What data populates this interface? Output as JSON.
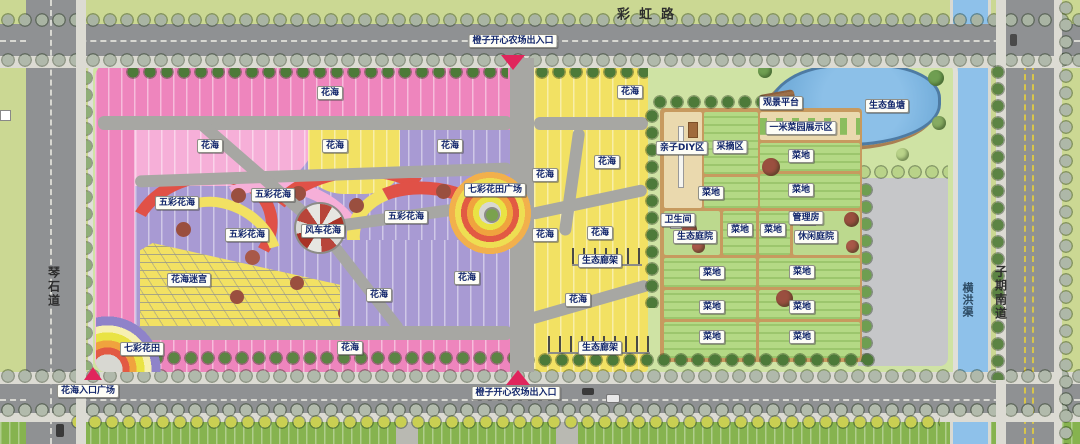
{
  "map": {
    "title": "橙子开心农场 平面图",
    "roads": {
      "north_road": "彩虹路",
      "west_road": "琴石道",
      "east_road": "子期南道",
      "east_channel": "横洪渠"
    },
    "entrances": {
      "north": "橙子开心农场出入口",
      "south": "橙子开心农场出入口",
      "southwest_plaza": "花海入口广场"
    },
    "labels": [
      {
        "t": "彩虹路",
        "x": 650,
        "y": 13,
        "k": "roadh",
        "n": "road-label-caihong"
      },
      {
        "t": "琴石道",
        "x": 54,
        "y": 287,
        "k": "roadv",
        "n": "road-label-qinshi"
      },
      {
        "t": "子期南道",
        "x": 1001,
        "y": 293,
        "k": "roadv",
        "n": "road-label-ziqinan"
      },
      {
        "t": "横洪渠",
        "x": 967,
        "y": 300,
        "k": "roadv-water",
        "n": "channel-label-henghong"
      },
      {
        "t": "橙子开心农场出入口",
        "x": 513,
        "y": 41,
        "k": "area",
        "n": "entrance-label-north"
      },
      {
        "t": "橙子开心农场出入口",
        "x": 516,
        "y": 393,
        "k": "area",
        "n": "entrance-label-south"
      },
      {
        "t": "花海入口广场",
        "x": 88,
        "y": 391,
        "k": "area",
        "n": "entrance-label-flower-plaza"
      },
      {
        "t": "花海",
        "x": 330,
        "y": 93,
        "k": "area",
        "n": "label-flower-sea"
      },
      {
        "t": "花海",
        "x": 210,
        "y": 146,
        "k": "area",
        "n": "label-flower-sea"
      },
      {
        "t": "花海",
        "x": 335,
        "y": 146,
        "k": "area",
        "n": "label-flower-sea"
      },
      {
        "t": "花海",
        "x": 450,
        "y": 146,
        "k": "area",
        "n": "label-flower-sea"
      },
      {
        "t": "五彩花海",
        "x": 273,
        "y": 195,
        "k": "area",
        "n": "label-multicolor-flower-sea"
      },
      {
        "t": "五彩花海",
        "x": 177,
        "y": 203,
        "k": "area",
        "n": "label-multicolor-flower-sea"
      },
      {
        "t": "五彩花海",
        "x": 247,
        "y": 235,
        "k": "area",
        "n": "label-multicolor-flower-sea"
      },
      {
        "t": "风车花海",
        "x": 323,
        "y": 231,
        "k": "area",
        "n": "label-windmill-flower-sea"
      },
      {
        "t": "五彩花海",
        "x": 406,
        "y": 217,
        "k": "area",
        "n": "label-multicolor-flower-sea"
      },
      {
        "t": "七彩花田广场",
        "x": 495,
        "y": 190,
        "k": "area",
        "n": "label-rainbow-field-plaza"
      },
      {
        "t": "花海迷宫",
        "x": 189,
        "y": 280,
        "k": "area",
        "n": "label-flower-maze"
      },
      {
        "t": "花海",
        "x": 379,
        "y": 295,
        "k": "area",
        "n": "label-flower-sea"
      },
      {
        "t": "花海",
        "x": 467,
        "y": 278,
        "k": "area",
        "n": "label-flower-sea"
      },
      {
        "t": "花海",
        "x": 350,
        "y": 348,
        "k": "area",
        "n": "label-flower-sea"
      },
      {
        "t": "七彩花田",
        "x": 142,
        "y": 349,
        "k": "area",
        "n": "label-rainbow-flower-field"
      },
      {
        "t": "花海",
        "x": 630,
        "y": 92,
        "k": "area",
        "n": "label-flower-sea"
      },
      {
        "t": "花海",
        "x": 607,
        "y": 162,
        "k": "area",
        "n": "label-flower-sea"
      },
      {
        "t": "花海",
        "x": 545,
        "y": 175,
        "k": "area",
        "n": "label-flower-sea"
      },
      {
        "t": "花海",
        "x": 545,
        "y": 235,
        "k": "area",
        "n": "label-flower-sea"
      },
      {
        "t": "花海",
        "x": 600,
        "y": 233,
        "k": "area",
        "n": "label-flower-sea"
      },
      {
        "t": "生态廊架",
        "x": 600,
        "y": 261,
        "k": "area",
        "n": "label-eco-pergola"
      },
      {
        "t": "花海",
        "x": 578,
        "y": 300,
        "k": "area",
        "n": "label-flower-sea"
      },
      {
        "t": "生态廊架",
        "x": 600,
        "y": 348,
        "k": "area",
        "n": "label-eco-pergola"
      },
      {
        "t": "亲子DIY区",
        "x": 682,
        "y": 148,
        "k": "area",
        "n": "label-family-diy-zone"
      },
      {
        "t": "采摘区",
        "x": 730,
        "y": 147,
        "k": "area",
        "n": "label-picking-zone"
      },
      {
        "t": "一米菜园展示区",
        "x": 801,
        "y": 128,
        "k": "area",
        "n": "label-one-meter-garden"
      },
      {
        "t": "观景平台",
        "x": 781,
        "y": 103,
        "k": "area",
        "n": "label-viewing-platform"
      },
      {
        "t": "生态鱼塘",
        "x": 887,
        "y": 106,
        "k": "area",
        "n": "label-eco-fish-pond"
      },
      {
        "t": "菜地",
        "x": 801,
        "y": 156,
        "k": "area",
        "n": "label-vegetable-plot"
      },
      {
        "t": "菜地",
        "x": 711,
        "y": 193,
        "k": "area",
        "n": "label-vegetable-plot"
      },
      {
        "t": "菜地",
        "x": 801,
        "y": 190,
        "k": "area",
        "n": "label-vegetable-plot"
      },
      {
        "t": "卫生间",
        "x": 678,
        "y": 220,
        "k": "area",
        "n": "label-restroom"
      },
      {
        "t": "生态庭院",
        "x": 695,
        "y": 237,
        "k": "area",
        "n": "label-eco-courtyard"
      },
      {
        "t": "菜地",
        "x": 740,
        "y": 230,
        "k": "area",
        "n": "label-vegetable-plot"
      },
      {
        "t": "菜地",
        "x": 773,
        "y": 230,
        "k": "area",
        "n": "label-vegetable-plot"
      },
      {
        "t": "管理房",
        "x": 806,
        "y": 218,
        "k": "area",
        "n": "label-management-house"
      },
      {
        "t": "休闲庭院",
        "x": 816,
        "y": 237,
        "k": "area",
        "n": "label-leisure-courtyard"
      },
      {
        "t": "菜地",
        "x": 712,
        "y": 273,
        "k": "area",
        "n": "label-vegetable-plot"
      },
      {
        "t": "菜地",
        "x": 802,
        "y": 272,
        "k": "area",
        "n": "label-vegetable-plot"
      },
      {
        "t": "菜地",
        "x": 712,
        "y": 307,
        "k": "area",
        "n": "label-vegetable-plot"
      },
      {
        "t": "菜地",
        "x": 802,
        "y": 307,
        "k": "area",
        "n": "label-vegetable-plot"
      },
      {
        "t": "菜地",
        "x": 712,
        "y": 337,
        "k": "area",
        "n": "label-vegetable-plot"
      },
      {
        "t": "菜地",
        "x": 802,
        "y": 337,
        "k": "area",
        "n": "label-vegetable-plot"
      }
    ],
    "colors": {
      "flower_pink": "#ee85bd",
      "flower_pink_light": "#f6afd8",
      "flower_yellow": "#f2e163",
      "flower_purple": "#a89ad3",
      "swirl_red": "#e05147",
      "road_gray": "#8f9193",
      "sidewalk": "#dcdbd3",
      "grass_verge": "#cbd893",
      "grass_light": "#cfe3a4",
      "farm_green": "#b4d985",
      "farm_border": "#c79a5f",
      "diy_beige": "#ead9ae",
      "pond_blue": "#74aedb",
      "channel_blue": "#8ec1ea",
      "paved_gray": "#c6c7c9",
      "entrance_red": "#e0255c"
    }
  }
}
